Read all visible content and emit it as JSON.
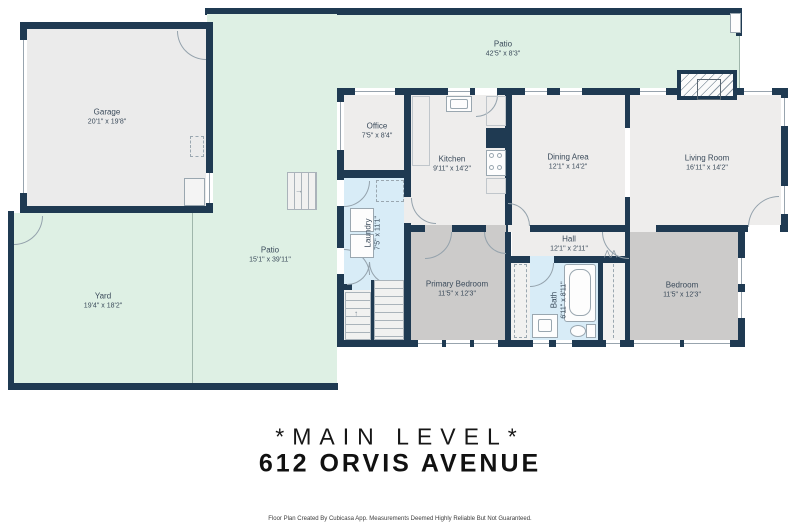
{
  "meta": {
    "level_title": "*MAIN LEVEL*",
    "address": "612 ORVIS AVENUE",
    "footer": "Floor Plan Created By Cubicasa App. Measurements Deemed Highly Reliable But Not Guaranteed."
  },
  "colors": {
    "wall": "#1f3a52",
    "outdoor_green": "#def0e4",
    "floor_light": "#eeedec",
    "floor_bedroom": "#cccbca",
    "floor_wet": "#d8ecf7",
    "floor_garage": "#ebebeb",
    "label_text": "#3a4a5a"
  },
  "rooms": {
    "garage": {
      "label": "Garage",
      "dims": "20'1\" x 19'8\""
    },
    "patio_top": {
      "label": "Patio",
      "dims": "42'5\" x 8'3\""
    },
    "patio_left": {
      "label": "Patio",
      "dims": "15'1\" x 39'11\""
    },
    "yard": {
      "label": "Yard",
      "dims": "19'4\" x 18'2\""
    },
    "office": {
      "label": "Office",
      "dims": "7'5\" x 8'4\""
    },
    "kitchen": {
      "label": "Kitchen",
      "dims": "9'11\" x 14'2\""
    },
    "dining": {
      "label": "Dining Area",
      "dims": "12'1\" x 14'2\""
    },
    "living": {
      "label": "Living Room",
      "dims": "16'11\" x 14'2\""
    },
    "laundry": {
      "label": "Laundry",
      "dims": "7'5\" x 11'1\""
    },
    "hall": {
      "label": "Hall",
      "dims": "12'1\" x 2'11\""
    },
    "primary_bedroom": {
      "label": "Primary Bedroom",
      "dims": "11'5\" x 12'3\""
    },
    "bath": {
      "label": "Bath",
      "dims": "6'11\" x 8'11\""
    },
    "bedroom": {
      "label": "Bedroom",
      "dims": "11'5\" x 12'3\""
    }
  }
}
